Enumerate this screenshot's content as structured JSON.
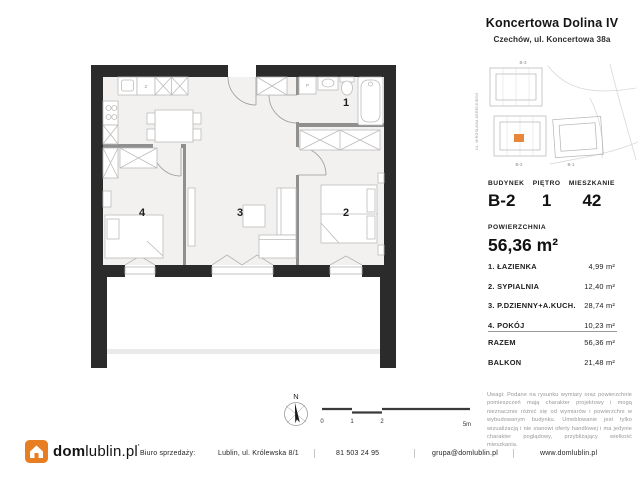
{
  "colors": {
    "accent_orange": "#E87E22",
    "unit_highlight": "#E8873A",
    "wall_dark": "#2B2B2B",
    "floor_fill": "#F2F1EF"
  },
  "header": {
    "title": "Koncertowa Dolina IV",
    "subtitle": "Czechów, ul. Koncertowa 38a"
  },
  "site_map": {
    "label_b3": "B-3",
    "label_b2": "B-2",
    "label_b1": "B-1",
    "street": "UL. MIROSŁAWA DERECKIEGO"
  },
  "plan": {
    "rooms": {
      "r1": "1",
      "r2": "2",
      "r3": "3",
      "r4": "4"
    },
    "fixtures": {
      "dishwasher": "Z",
      "washer": "P"
    },
    "compass": "N",
    "scale": {
      "t0": "0",
      "t1": "1",
      "t2": "2",
      "t5": "5m"
    }
  },
  "summary": {
    "budynek_label": "BUDYNEK",
    "budynek": "B-2",
    "pietro_label": "PIĘTRO",
    "pietro": "1",
    "mieszkanie_label": "MIESZKANIE",
    "mieszkanie": "42",
    "powierzchnia_label": "POWIERZCHNIA",
    "powierzchnia": "56,36 m²"
  },
  "room_list": [
    {
      "name": "1. ŁAZIENKA",
      "area": "4,99 m²"
    },
    {
      "name": "2. SYPIALNIA",
      "area": "12,40 m²"
    },
    {
      "name": "3. P.DZIENNY+A.KUCH.",
      "area": "28,74 m²"
    },
    {
      "name": "4. POKÓJ",
      "area": "10,23 m²"
    }
  ],
  "totals": [
    {
      "name": "RAZEM",
      "area": "56,36 m²"
    },
    {
      "name": "BALKON",
      "area": "21,48 m²"
    }
  ],
  "disclaimer": "Uwagi: Podane na rysunku wymiary oraz powierzchnie pomieszczeń mają charakter projektowy i mogą nieznacznie różnić się od wymiarów i powierzchni w wybudowanym budynku. Umeblowanie jest tylko wizualizacją i nie stanowi oferty handlowej i ma jedynie charakter poglądowy, przybliżający wielkość mieszkania.",
  "footer": {
    "logo_bold": "dom",
    "logo_rest": "lublin.pl",
    "logo_mark": "'",
    "office_label": "Biuro sprzedaży:",
    "address": "Lublin, ul. Królewska 8/1",
    "phone": "81 503 24 95",
    "email": "grupa@domlublin.pl",
    "website": "www.domlublin.pl"
  }
}
